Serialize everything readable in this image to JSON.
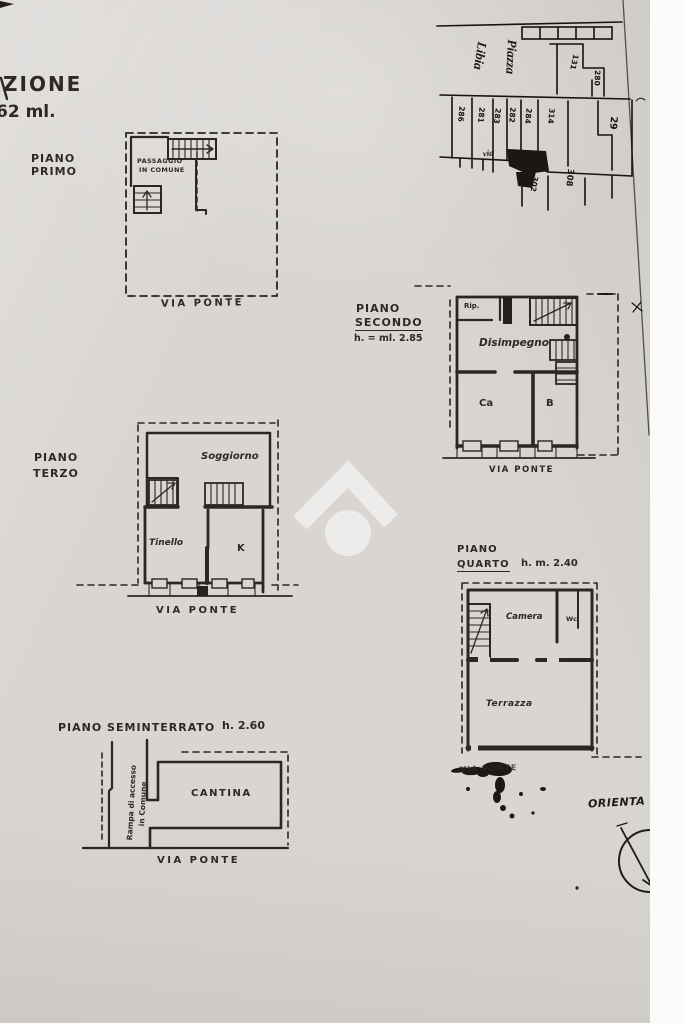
{
  "header_fragment": {
    "line1": "ZIONE",
    "line2": "62 ml."
  },
  "colors": {
    "paper": "#d8d5d2",
    "ink": "#2b2722",
    "map_ink": "#15110c",
    "white_margin": "#fbfbfa"
  },
  "plans": {
    "primo": {
      "title1": "PIANO",
      "title2": "PRIMO",
      "room_note1": "PASSAGGIO",
      "room_note2": "IN COMUNE",
      "street": "VIA PONTE"
    },
    "secondo": {
      "title1": "PIANO",
      "title2": "SECONDO",
      "height_note": "h. = ml. 2.85",
      "room_rip": "Rip.",
      "room_disimpegno": "Disimpegno",
      "room_ca": "Ca",
      "room_b": "B",
      "street": "VIA PONTE"
    },
    "terzo": {
      "title1": "PIANO",
      "title2": "TERZO",
      "room_soggiorno": "Soggiorno",
      "room_tinello": "Tinello",
      "room_k": "K",
      "street": "VIA PONTE"
    },
    "quarto": {
      "title1": "PIANO",
      "title2": "QUARTO",
      "height_note": "h. m. 2.40",
      "room_camera": "Camera",
      "room_wc": "Wc.",
      "room_terrazza": "Terrazza",
      "street": "VIA PONTE"
    },
    "seminterrato": {
      "title": "PIANO SEMINTERRATO",
      "height_note": "h. 2.60",
      "ramp_note1": "Rampa di accesso",
      "ramp_note2": "in Comune",
      "room_cantina": "CANTINA",
      "street": "VIA PONTE"
    }
  },
  "map": {
    "piazza_label1": "Piazza",
    "piazza_label2": "Libia",
    "via_label": "via",
    "parcel_numbers": [
      "131",
      "280",
      "286",
      "281",
      "283",
      "282",
      "284",
      "314",
      "29",
      "302",
      "308"
    ]
  },
  "orientation_label": "ORIENTA"
}
